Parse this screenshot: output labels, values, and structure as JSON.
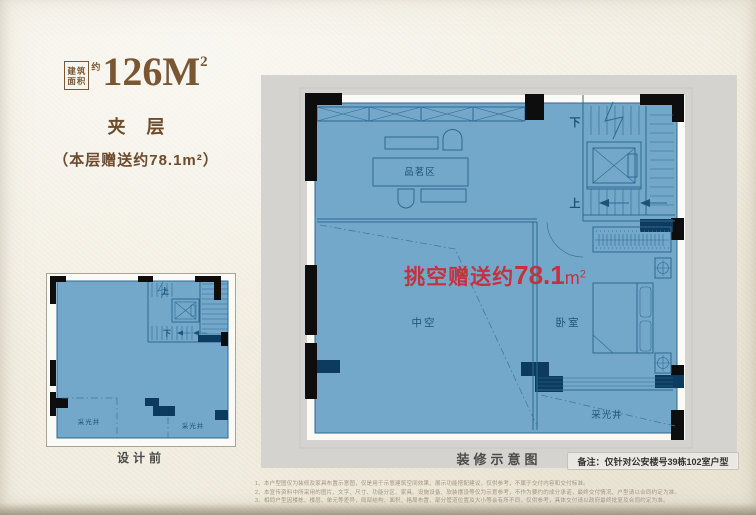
{
  "colors": {
    "paper": "#f2eee1",
    "brown": "#7a5633",
    "brown_dark": "#6d4b2c",
    "red": "#c4323f",
    "blue_fill": "#74a8ca",
    "blue_line": "#2e6a92",
    "blue_text": "#1d5379",
    "navy": "#0d3a5f",
    "wall_black": "#0d0d0d",
    "band_gray": "#d5d3cf",
    "caption_gray": "#4b4b4b",
    "disclaimer": "#a59384"
  },
  "header": {
    "area_box": [
      "建筑",
      "面积"
    ],
    "approx": "约",
    "area_value": "126M",
    "area_sup": "2",
    "floor_name": "夹 层",
    "gift_note": "（本层赠送约78.1m²）"
  },
  "main_plan": {
    "caption": "装修示意图",
    "note": "备注：仅针对公安楼号39栋102室户型",
    "highlight": {
      "prefix": "挑空赠送约",
      "value": "78.1",
      "unit": "m",
      "sup": "2"
    },
    "labels": {
      "tea_area": "品茗区",
      "void_space": "中空",
      "bedroom": "卧室",
      "light_well": "采光井",
      "up": "上",
      "down": "下"
    }
  },
  "small_plan": {
    "caption": "设计前",
    "labels": {
      "up": "上",
      "down": "下",
      "light_well_left": "采光井",
      "light_well_right": "采光井"
    }
  },
  "disclaimer": {
    "lines": [
      "1、本户型图仅为装修及家具布置示意图，仅是用于示意建筑空间效果、展示功能搭配建议，仅供参考，不属于交付内容和交付标准。",
      "2、本宣传资料中所采用的图片、文字、尺寸、功能分区、家具、设施设备、软装摆设等仅为示意参考，不作为要约的成分承诺，最终交付情况、户型请以合同约定为准。",
      "3、相同户型因楼栋、楼层、单元等差异，局部结构、面积、格局布置、部分管道位置及大小等会有所不同，仅供参考，具体交付请以政府最终批复及合同约定为准。"
    ]
  }
}
